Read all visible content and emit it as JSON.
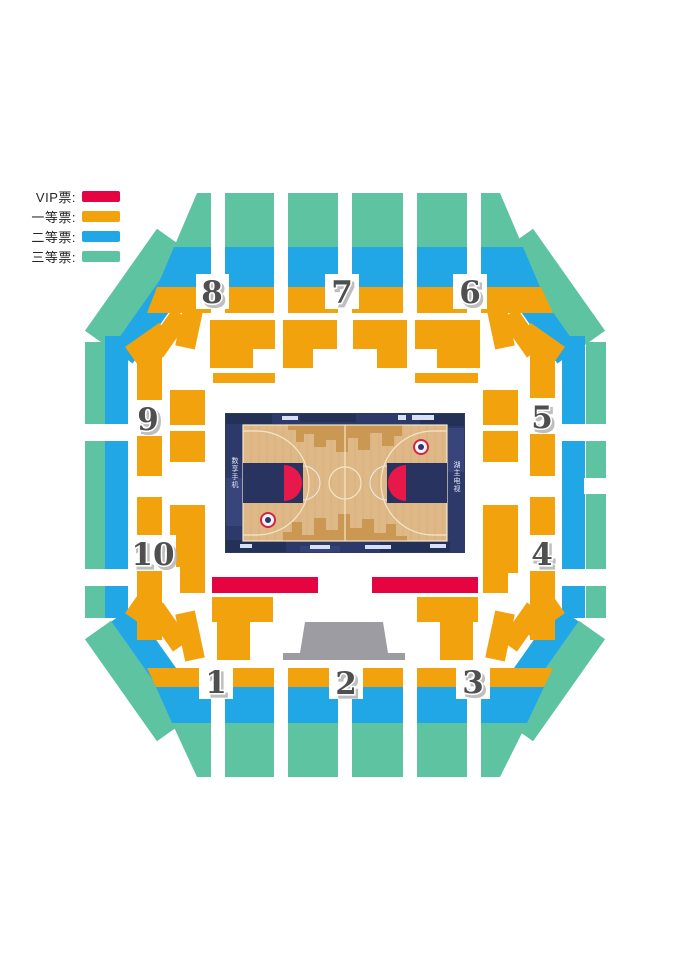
{
  "legend": {
    "items": [
      {
        "label": "VIP票:",
        "tier": "vip"
      },
      {
        "label": "一等票:",
        "tier": "tier1"
      },
      {
        "label": "二等票:",
        "tier": "tier2"
      },
      {
        "label": "三等票:",
        "tier": "tier3"
      }
    ]
  },
  "colors": {
    "vip": "#e50341",
    "tier1": "#f2a20c",
    "tier2": "#22a7e6",
    "tier3": "#5ec3a1",
    "stage": "#9c9ca2",
    "apron": "#2d3a69",
    "apron_dark": "#243156",
    "apron_light": "#3f4e88",
    "wood": "#dfb887",
    "wood_pattern": "#c9954e",
    "court_line": "#f3e6c8",
    "key": "#28335f",
    "key_red": "#e8194a",
    "number": "#4f4f4f",
    "number_shadow": "#b3b3b3",
    "legend_text": "#262626"
  },
  "sections": [
    {
      "label": "1"
    },
    {
      "label": "2"
    },
    {
      "label": "3"
    },
    {
      "label": "4"
    },
    {
      "label": "5"
    },
    {
      "label": "6"
    },
    {
      "label": "7"
    },
    {
      "label": "8"
    },
    {
      "label": "9"
    },
    {
      "label": "10"
    }
  ],
  "court": {
    "apron_text_left": "数享手机",
    "apron_text_right": "湖主电视"
  }
}
